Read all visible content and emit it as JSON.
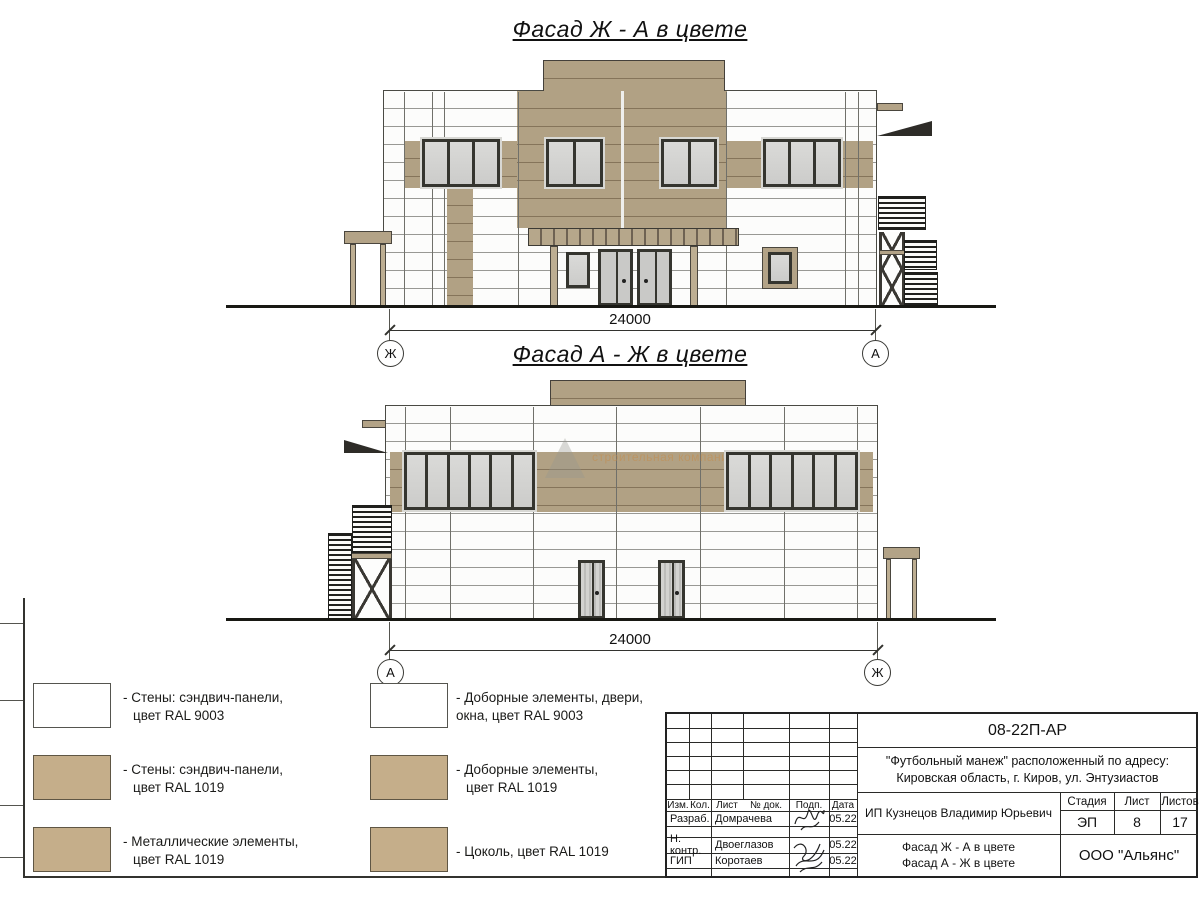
{
  "sheet": {
    "facade1_title": "Фасад Ж - А в цвете",
    "facade2_title": "Фасад А - Ж в цвете"
  },
  "dimensions": {
    "facade1": {
      "value": "24000",
      "left_axis": "Ж",
      "right_axis": "А"
    },
    "facade2": {
      "value": "24000",
      "left_axis": "А",
      "right_axis": "Ж"
    }
  },
  "watermark": {
    "text": "строительная компания"
  },
  "legend": {
    "items": [
      {
        "tone": "white",
        "line1": "- Стены: сэндвич-панели,",
        "line2": "цвет RAL 9003"
      },
      {
        "tone": "tan",
        "line1": "- Стены: сэндвич-панели,",
        "line2": "цвет RAL 1019"
      },
      {
        "tone": "tan",
        "line1": "- Металлические элементы,",
        "line2": "цвет RAL 1019"
      },
      {
        "tone": "white",
        "line1": "- Доборные элементы, двери,",
        "line2": "окна, цвет RAL 9003"
      },
      {
        "tone": "tan",
        "line1": "- Доборные элементы,",
        "line2": "цвет RAL 1019"
      },
      {
        "tone": "tan",
        "line1": "- Цоколь, цвет RAL 1019",
        "line2": ""
      }
    ]
  },
  "title_block": {
    "doc_number": "08-22П-АР",
    "project_line1": "\"Футбольный манеж\" расположенный по адресу:",
    "project_line2": "Кировская область, г. Киров, ул. Энтузиастов",
    "columns": [
      "Изм.",
      "Кол.",
      "Лист",
      "№ док.",
      "Подп.",
      "Дата"
    ],
    "personnel": [
      {
        "role": "Разраб.",
        "name": "Домрачева",
        "date": "05.22"
      },
      {
        "role": "Н. контр.",
        "name": "Двоеглазов",
        "date": "05.22"
      },
      {
        "role": "ГИП",
        "name": "Коротаев",
        "date": "05.22"
      }
    ],
    "client": "ИП Кузнецов Владимир Юрьевич",
    "stage_header": "Стадия",
    "sheet_header": "Лист",
    "sheets_header": "Листов",
    "stage": "ЭП",
    "sheet_number": "8",
    "sheets_total": "17",
    "drawing_title_line1": "Фасад Ж - А в цвете",
    "drawing_title_line2": "Фасад А - Ж в цвете",
    "company": "ООО \"Альянс\""
  },
  "colors": {
    "panel_white": "#fcfcfb",
    "panel_tan": "#b1a184",
    "legend_tan": "#c5ae8a",
    "glass": "#d6d6d4",
    "metal_dark": "#1f1f1c"
  }
}
